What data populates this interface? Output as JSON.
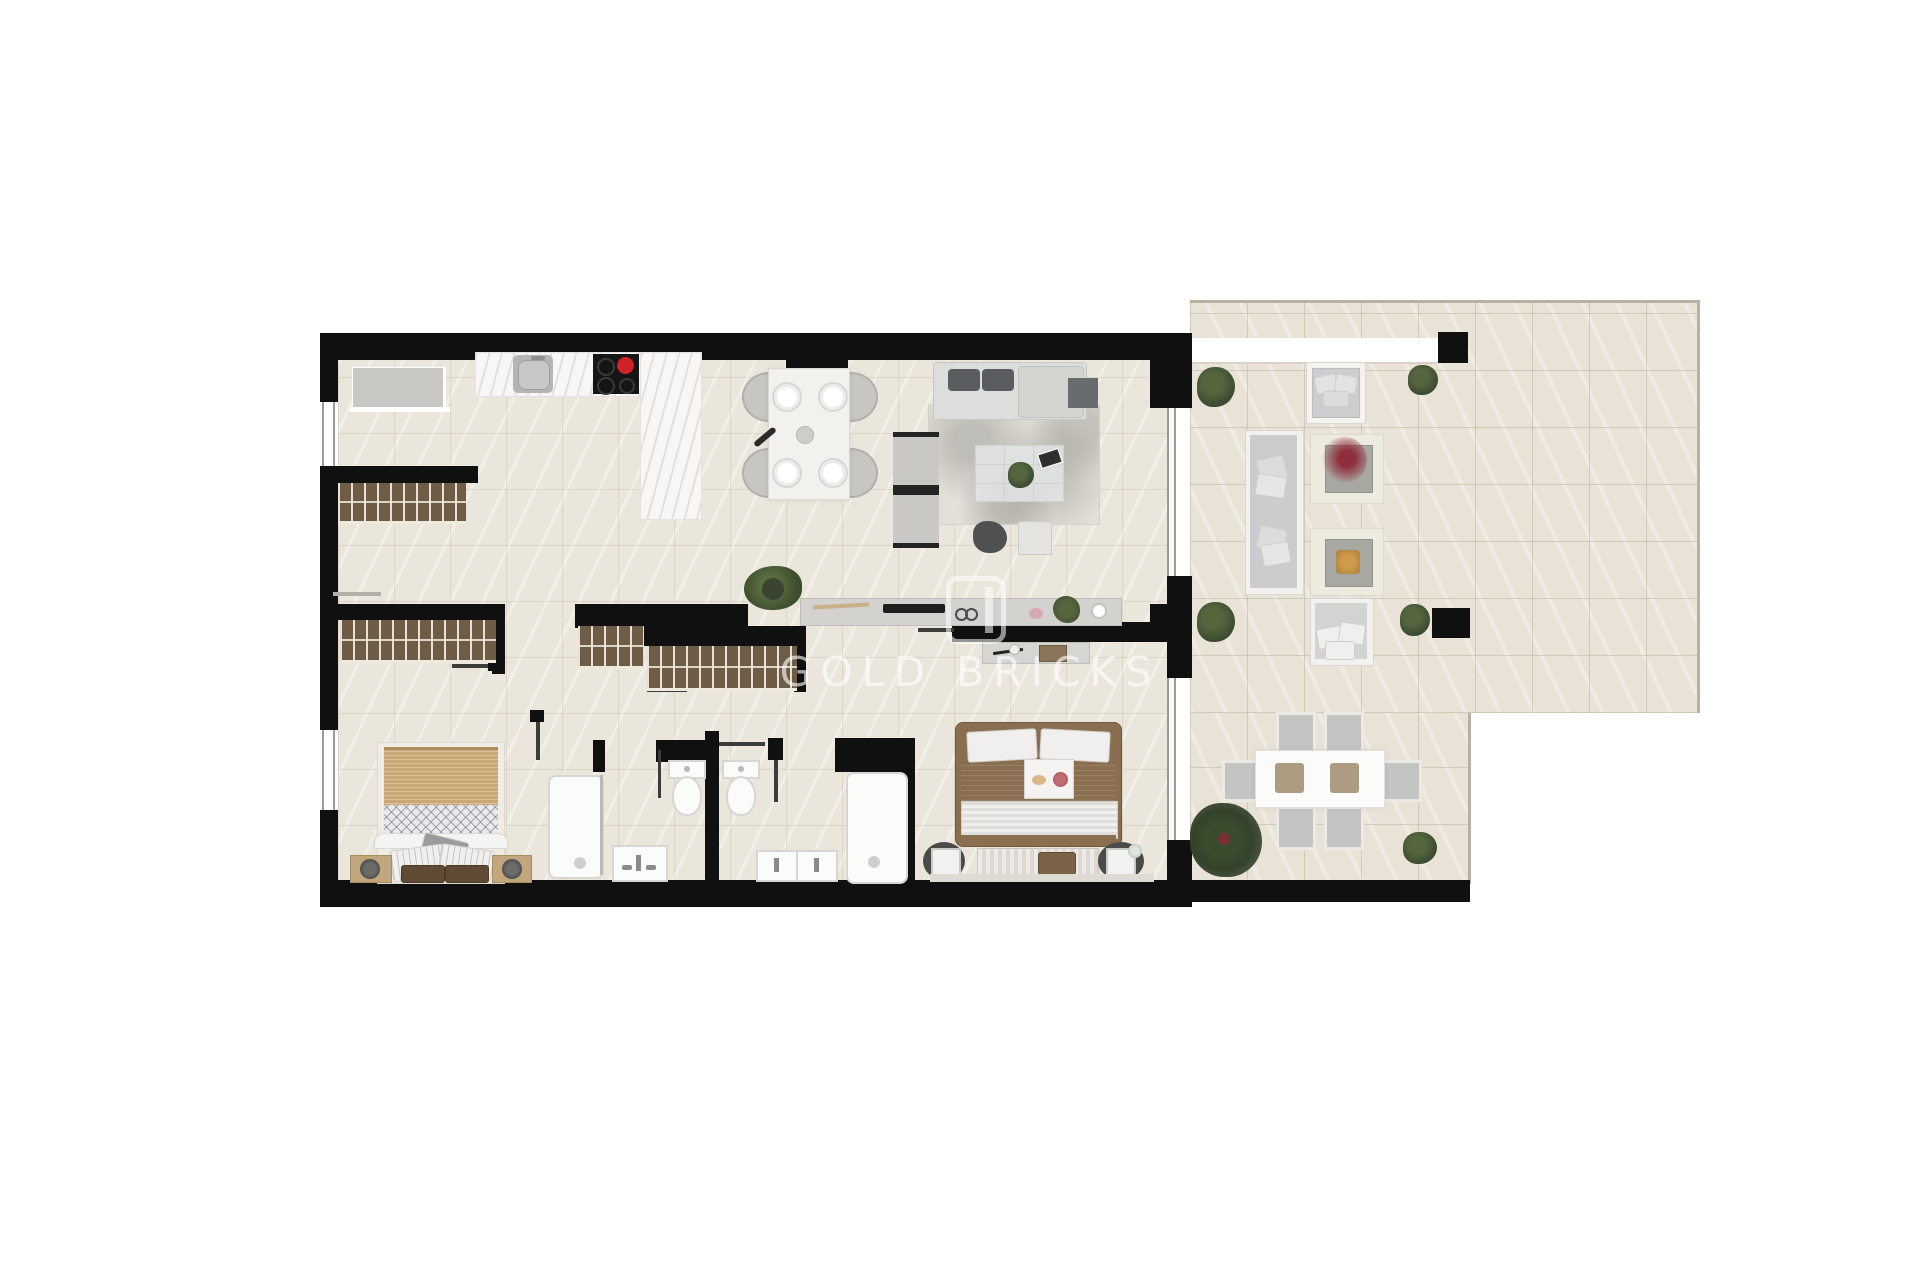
{
  "watermark": {
    "text": "GOLD BRICKS"
  },
  "palette": {
    "wall": "#101010",
    "floor_indoor": "#ebe6db",
    "floor_terrace": "#e8e3d6",
    "terrace_border": "#b7b1a1",
    "marble": "#f8f7f5",
    "wardrobe_wood": "#6e5c46",
    "wardrobe_slat": "#e8e1d3",
    "furn_gray": "#c9c8c5",
    "furn_gray_dark": "#5a5d60",
    "bed1_tan": "#c9a875",
    "bed2_brown": "#8a6e50",
    "fixture_white": "#fbfbfa",
    "fixture_border": "#d6d6d2",
    "glass_gray": "#9a9a98",
    "plant_green": "#44543a",
    "accent_red": "#cf2127",
    "flower_red": "#8e2f3c",
    "fire_gold": "#cf9a4a",
    "rug": "#e3e0da"
  },
  "floorplan": {
    "type": "apartment-top-view",
    "rooms": [
      {
        "name": "kitchen",
        "items": [
          "appliance-block",
          "worktop",
          "sink",
          "cooktop",
          "island"
        ]
      },
      {
        "name": "entry-hall",
        "items": [
          "wardrobe-entry",
          "shelf"
        ]
      },
      {
        "name": "dining-area",
        "items": [
          "dining-table",
          "4-chairs",
          "4-plates",
          "bottle",
          "vase"
        ]
      },
      {
        "name": "living-room",
        "items": [
          "sofa",
          "dark-cushions",
          "side-table",
          "2-armchairs",
          "glass-coffee-table",
          "plant",
          "pouf",
          "rug",
          "sideboard-desk"
        ]
      },
      {
        "name": "hallway",
        "items": [
          "wardrobe-2",
          "wardrobe-3",
          "potted-plant"
        ]
      },
      {
        "name": "bedroom-1",
        "items": [
          "wardrobe-1",
          "double-bed",
          "2-nightstands",
          "2-lamps"
        ]
      },
      {
        "name": "bathroom-1",
        "items": [
          "shower",
          "vanity-sink",
          "toilet"
        ]
      },
      {
        "name": "bathroom-2",
        "items": [
          "double-vanity",
          "toilet",
          "large-shower"
        ]
      },
      {
        "name": "bedroom-2",
        "items": [
          "double-bed",
          "breakfast-tray",
          "foot-bench",
          "2-nightstands",
          "dresser"
        ]
      },
      {
        "name": "terrace",
        "items": [
          "planter-band",
          "3-bushes-top",
          "outdoor-armchair",
          "outdoor-sofa",
          "flower-table",
          "fire-pit-table",
          "day-bed",
          "outdoor-dining-table",
          "6-outdoor-chairs",
          "large-plant",
          "2-bushes-bottom",
          "sliding-glass-doors"
        ]
      }
    ]
  }
}
